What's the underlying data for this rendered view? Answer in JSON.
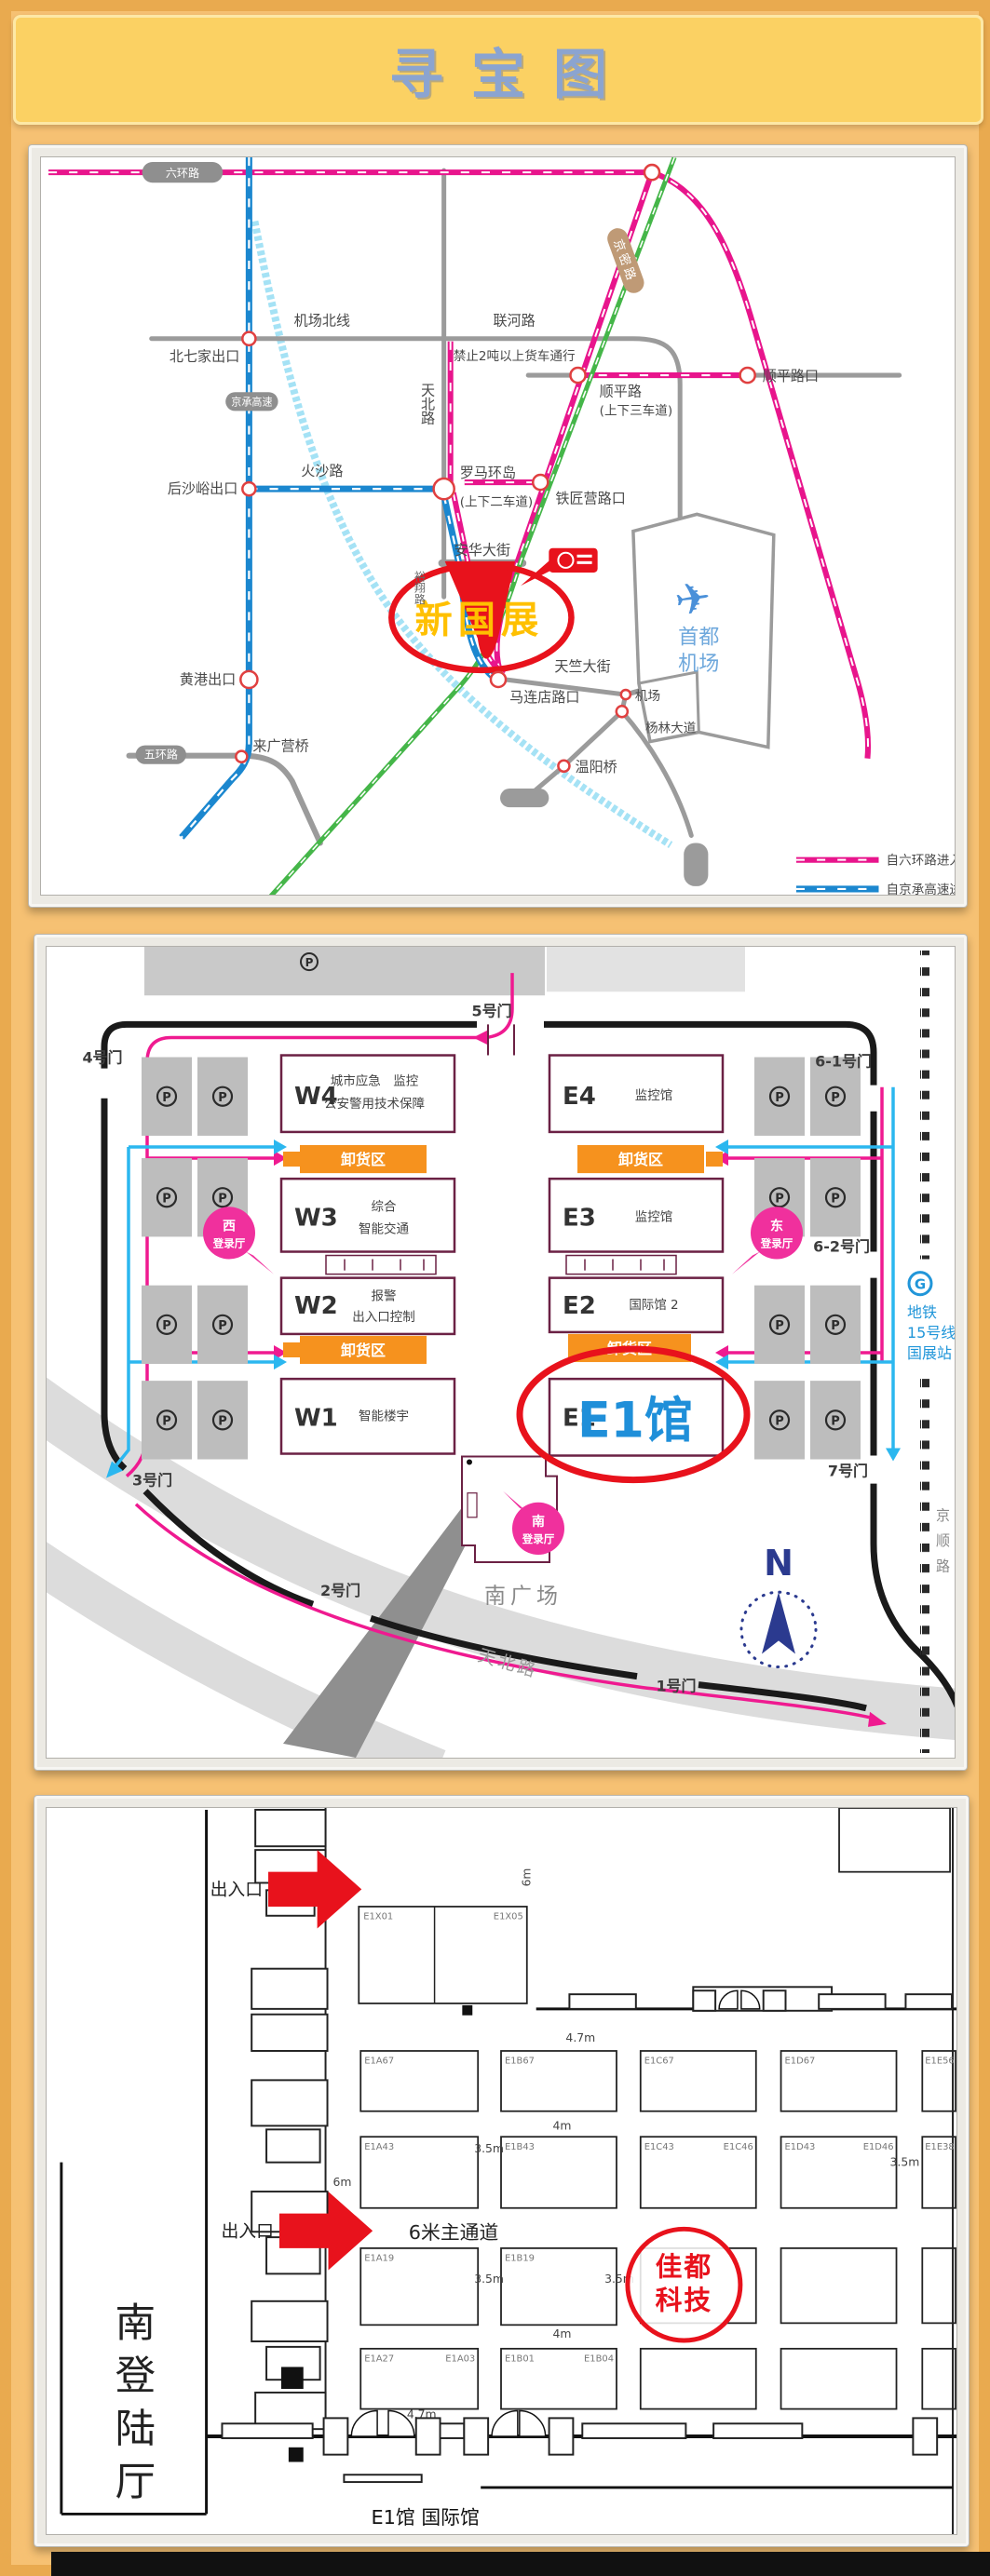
{
  "title": "寻宝图",
  "panel1": {
    "pills": {
      "ring6": "六环路",
      "jingcheng": "京承高速",
      "ring5": "五环路",
      "jingmi": "京密路"
    },
    "roads": {
      "airport_north": "机场北线",
      "lianhe": "联河路",
      "truck_ban": "禁止2吨以上货车通行",
      "tianbei": "天北路",
      "huosha": "火沙路",
      "shunping": "顺平路",
      "shunping_note": "(上下三车道)",
      "lanes_note": "(上下二车道)",
      "anhua": "安华大街",
      "tianzhu": "天竺大街",
      "yanglin": "杨林大道",
      "yuxiang": "裕翔路"
    },
    "exits": {
      "beiqijia": "北七家出口",
      "housha": "后沙峪出口",
      "roma": "罗马环岛",
      "shunping_kou": "顺平路口",
      "tiejiang": "铁匠营路口",
      "malian": "马连店路口",
      "jichang": "机场",
      "wenyang": "温阳桥",
      "huanggang": "黄港出口",
      "laiguangying": "来广营桥"
    },
    "venue": "新国展",
    "airport": {
      "line1": "首都",
      "line2": "机场",
      "plane": "✈"
    },
    "legend": {
      "item1": "自六环路进入",
      "item2": "自京承高速进入"
    }
  },
  "panel2": {
    "gates": {
      "g1": "1号门",
      "g2": "2号门",
      "g3": "3号门",
      "g4": "4号门",
      "g5": "5号门",
      "g61": "6-1号门",
      "g62": "6-2号门",
      "g7": "7号门"
    },
    "halls_w": [
      {
        "code": "W4",
        "line1": "城市应急　监控",
        "line2": "公安警用技术保障"
      },
      {
        "code": "W3",
        "line1": "综合",
        "line2": "智能交通"
      },
      {
        "code": "W2",
        "line1": "报警",
        "line2": "出入口控制"
      },
      {
        "code": "W1",
        "line1": "智能楼宇"
      }
    ],
    "halls_e": [
      {
        "code": "E4",
        "line1": "监控馆"
      },
      {
        "code": "E3",
        "line1": "监控馆"
      },
      {
        "code": "E2",
        "line1": "国际馆 2"
      },
      {
        "code": "E1",
        "line1": ""
      }
    ],
    "unload": "卸货区",
    "e1_highlight": "E1馆",
    "bubbles": {
      "west_dir": "西",
      "east_dir": "东",
      "south_dir": "南",
      "hall": "登录厅"
    },
    "plaza": "南广场",
    "tianbei": "天北路",
    "north": "N",
    "metro": {
      "logo": "G",
      "line1": "地铁",
      "line2": "15号线",
      "line3": "国展站"
    },
    "jingshun": "京顺路",
    "parking": "P"
  },
  "panel3": {
    "entrance": "出入口",
    "aisle": "6米主通道",
    "target": {
      "line1": "佳都",
      "line2": "科技"
    },
    "south_hall": "南登陆厅",
    "hall_label": "E1馆 国际馆",
    "dims": {
      "m6": "6m",
      "m47": "4.7m",
      "m4": "4m",
      "m35": "3.5m"
    },
    "booths": {
      "x01": "E1X01",
      "x05": "E1X05",
      "a67": "E1A67",
      "b67": "E1B67",
      "c67": "E1C67",
      "d67": "E1D67",
      "e56": "E1E56",
      "a43": "E1A43",
      "b43": "E1B43",
      "c43": "E1C43",
      "c46": "E1C46",
      "d43": "E1D43",
      "d46": "E1D46",
      "e38": "E1E38",
      "a19": "E1A19",
      "b19": "E1B19",
      "a27": "E1A27",
      "a03": "E1A03",
      "b01": "E1B01",
      "b04": "E1B04"
    }
  }
}
